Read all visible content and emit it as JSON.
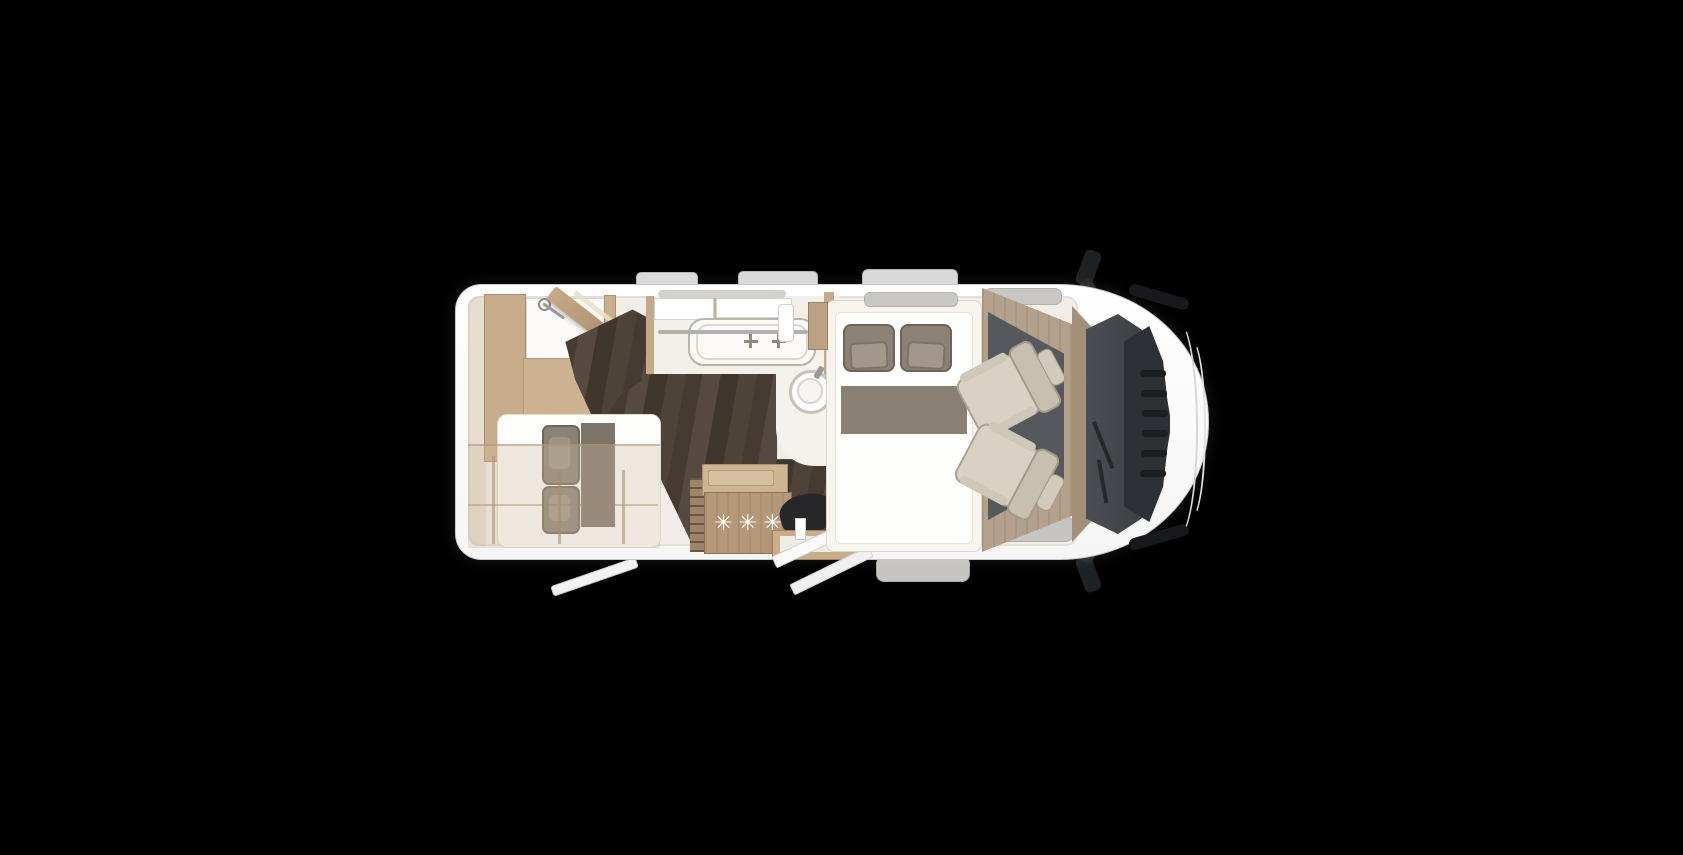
{
  "scene": {
    "type": "motorhome-floorplan-top-view",
    "orientation": "front-of-vehicle-right"
  },
  "labels": {
    "fridge_stars": "✳✳✳"
  },
  "colors": {
    "bg": "#000000",
    "body": "#ffffff",
    "body_edge": "#c8c8c8",
    "interior": "#f2eee7",
    "interior_edge": "#e4dfd4",
    "wood_light": "#cdb394",
    "wood_mid": "#b5987a",
    "wood_wardrobe": "#c8ad8d",
    "wood_dark": "#8f7254",
    "wood_partition_hi": "#c7aa87",
    "wood_frame": "#a0835f",
    "plank_a": "#4e4339",
    "plank_b": "#453b32",
    "plank_c": "#554941",
    "plank_d": "#3f362e",
    "bath": "#f3f0ea",
    "white_soft": "#fbfaf7",
    "pillow": "#8b8174",
    "pillow_edge": "#6e665b",
    "pillow_inner": "#9e9486",
    "blanket": "#8a7f73",
    "runner": "#7e756a",
    "mattress": "#fdfdfb",
    "cab_tan": "#b3a18c",
    "cab_tan_dark": "#a4907a",
    "cab_floor": "#55585c",
    "seat": "#d9d2c4",
    "seat_edge": "#aaa193",
    "seat_back": "#c7bfb0",
    "seat_head": "#d2cabb",
    "windshield_a": "#4b4f53",
    "windshield_b": "#35383c",
    "cowl": "#2d3034",
    "grille": "#1c1f22",
    "black_part": "#1e2123",
    "dark_seat": "#27272a",
    "gray_tab": "#d9d9d9",
    "gray_window": "#c9c8c5",
    "gray_plate": "#c6c5c2",
    "chrome": "#b0b0b0",
    "star_white": "#ffffff"
  }
}
